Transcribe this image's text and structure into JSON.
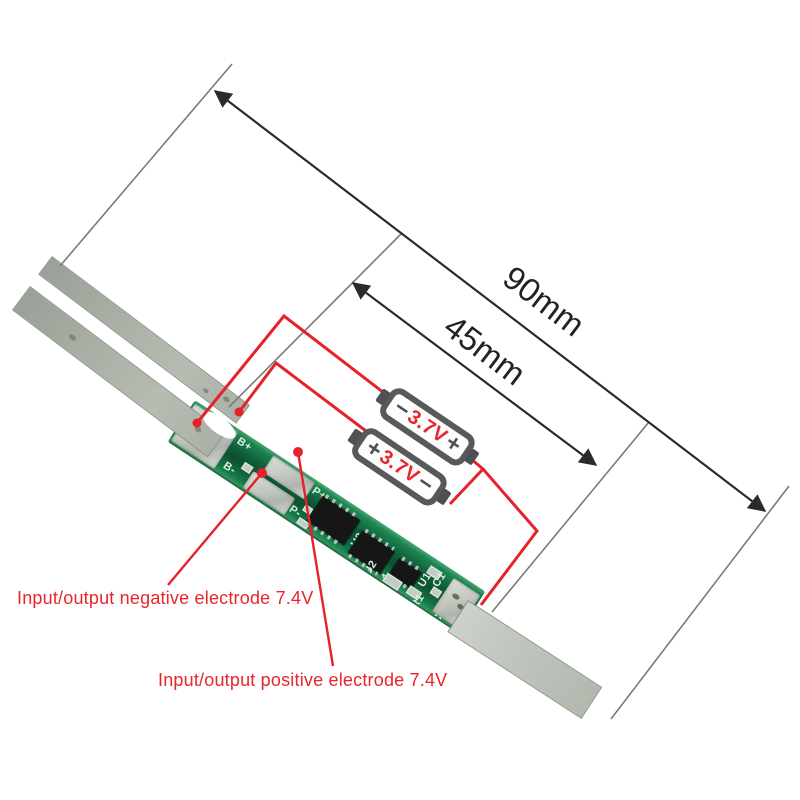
{
  "dimensions": {
    "total_length": {
      "label": "90mm"
    },
    "board_length": {
      "label": "45mm"
    }
  },
  "batteries": [
    {
      "left_terminal": "−",
      "label": "3.7V",
      "right_terminal": "+"
    },
    {
      "left_terminal": "+",
      "label": "3.7V",
      "right_terminal": "−"
    }
  ],
  "annotations": {
    "negative": "Input/output negative electrode 7.4V",
    "positive": "Input/output positive electrode 7.4V"
  },
  "pcb": {
    "silkscreen": {
      "b_plus": "B+",
      "b_minus": "B-",
      "p_minus": "P-",
      "p_plus": "P+",
      "u1": "U1",
      "u2": "U2",
      "u3": "U3",
      "r4": "R4",
      "c1": "C1",
      "r1": "R1",
      "c2": "C2",
      "r2": "R2"
    }
  },
  "colors": {
    "annotation_red": "#e8252b",
    "wire_red": "#e6212a",
    "dimension_line": "#2b2b2b",
    "extension_line": "#7a7a7a",
    "board_green": "#0d5936",
    "pad_silver": "#c9cdc7",
    "battery_border": "#58595a"
  }
}
